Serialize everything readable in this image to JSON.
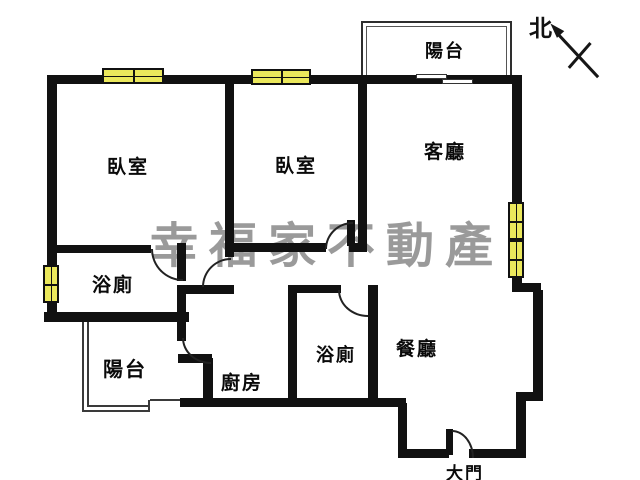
{
  "plan": {
    "title": "apartment-floor-plan",
    "compass_label": "北",
    "watermark": "幸福家不動產",
    "rooms": {
      "balcony_top": "陽台",
      "bedroom_left": "臥室",
      "bedroom_middle": "臥室",
      "living_room": "客廳",
      "bathroom_left": "浴廁",
      "balcony_bottom": "陽台",
      "kitchen": "廚房",
      "bathroom_right": "浴廁",
      "dining_room": "餐廳",
      "main_door": "大門"
    },
    "colors": {
      "wall": "#111111",
      "window_fill": "#ebe85c",
      "watermark_gray": "#848484",
      "background": "#ffffff"
    }
  }
}
